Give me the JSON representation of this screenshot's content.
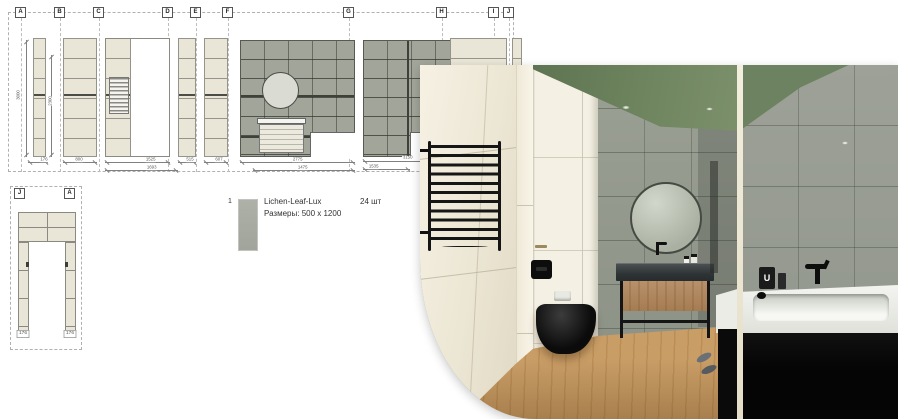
{
  "sheet": {
    "top_section_labels": [
      "A",
      "B",
      "C",
      "D",
      "E",
      "F",
      "G",
      "H",
      "I",
      "J"
    ],
    "door_section_labels": [
      "J",
      "A"
    ],
    "dimensions": {
      "a_total_height": "3000",
      "a_inner_height": "2300",
      "a_width": "176",
      "b_width": "800",
      "c_width": "1525",
      "c_total_width": "1693",
      "d_width": "515",
      "e_width": "607",
      "f_width": "2775",
      "f_inner_width": "1475",
      "g_width": "3150",
      "g_inner_width": "1535",
      "door_left_width": "176",
      "door_right_width": "176"
    },
    "legend": {
      "row_index": "1",
      "tile_name": "Lichen-Leaf-Lux",
      "tile_size": "Размеры: 500 x 1200",
      "tile_count": "24 шт",
      "swatch_color": "#a9ada3"
    }
  },
  "render": {
    "bottle_label": "U",
    "colors": {
      "ceiling_green": "#6e8460",
      "wall_gray": "#999d92",
      "tile_cream": "#f2eee1",
      "floor_wood": "#c2955e",
      "fixtures_black": "#121212",
      "tub_white": "#f1f2ed"
    }
  }
}
